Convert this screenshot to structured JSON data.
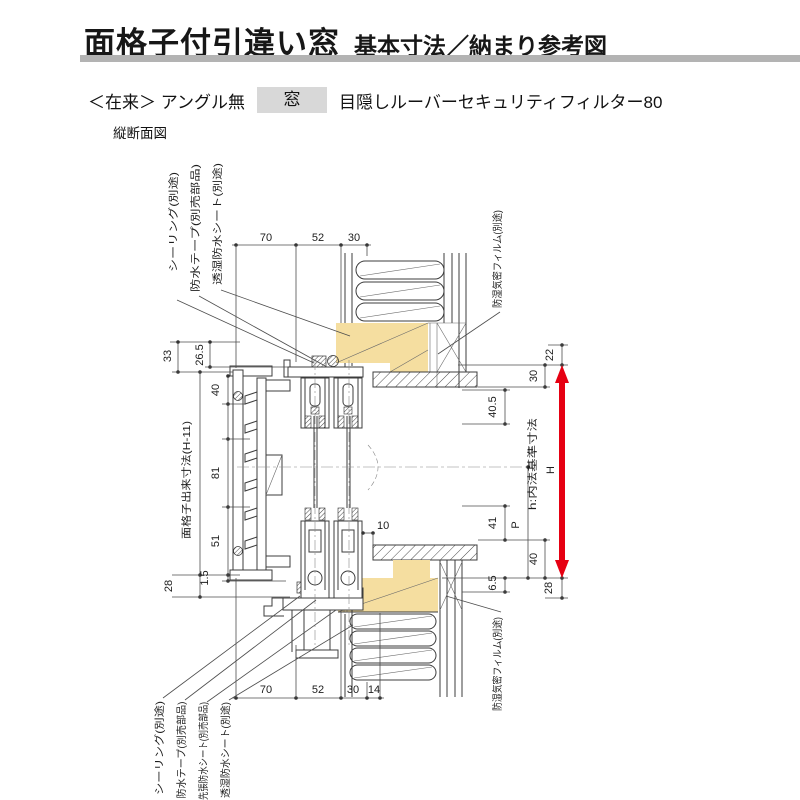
{
  "header": {
    "title": "面格子付引違い窓",
    "subtitle": "基本寸法／納まり参考図",
    "variant": "＜在来＞ アングル無",
    "window_box": "窓",
    "product": "目隠しルーバーセキュリティフィルター80",
    "view_label": "縦断面図"
  },
  "diagram": {
    "top_dims": {
      "d70": "70",
      "d52": "52",
      "d30": "30"
    },
    "bottom_dims": {
      "d70": "70",
      "d52": "52",
      "d30": "30",
      "d14": "14"
    },
    "left_dims": {
      "d33": "33",
      "d26_5": "26.5",
      "d40": "40",
      "d81": "81",
      "d51": "51",
      "d1_5": "1.5",
      "d28": "28",
      "grille_label": "面格子出来寸法(H-11)"
    },
    "right_dims": {
      "d22": "22",
      "d30": "30",
      "d40_5": "40.5",
      "d10": "10",
      "d41": "41",
      "dP": "P",
      "d40": "40",
      "d6_5": "6.5",
      "d28": "28",
      "h_label": "h:内法基準寸法",
      "H_label": "H"
    },
    "callouts": {
      "top_left": [
        "シーリング(別途)",
        "防水テープ(別売部品)",
        "透湿防水シート(別途)"
      ],
      "top_right": "防湿気密フィルム(別途)",
      "bottom_left": [
        "シーリング(別途)",
        "防水テープ(別売部品)",
        "先張防水シート(別売部品)",
        "透湿防水シート(別途)"
      ],
      "bottom_right": "防湿気密フィルム(別途)"
    },
    "colors": {
      "wood": "#f5dea0",
      "arrow": "#e60012",
      "title_bar": "#b3b3b3",
      "tag_bg": "#d8d8d8",
      "line": "#3c3c3c"
    }
  }
}
